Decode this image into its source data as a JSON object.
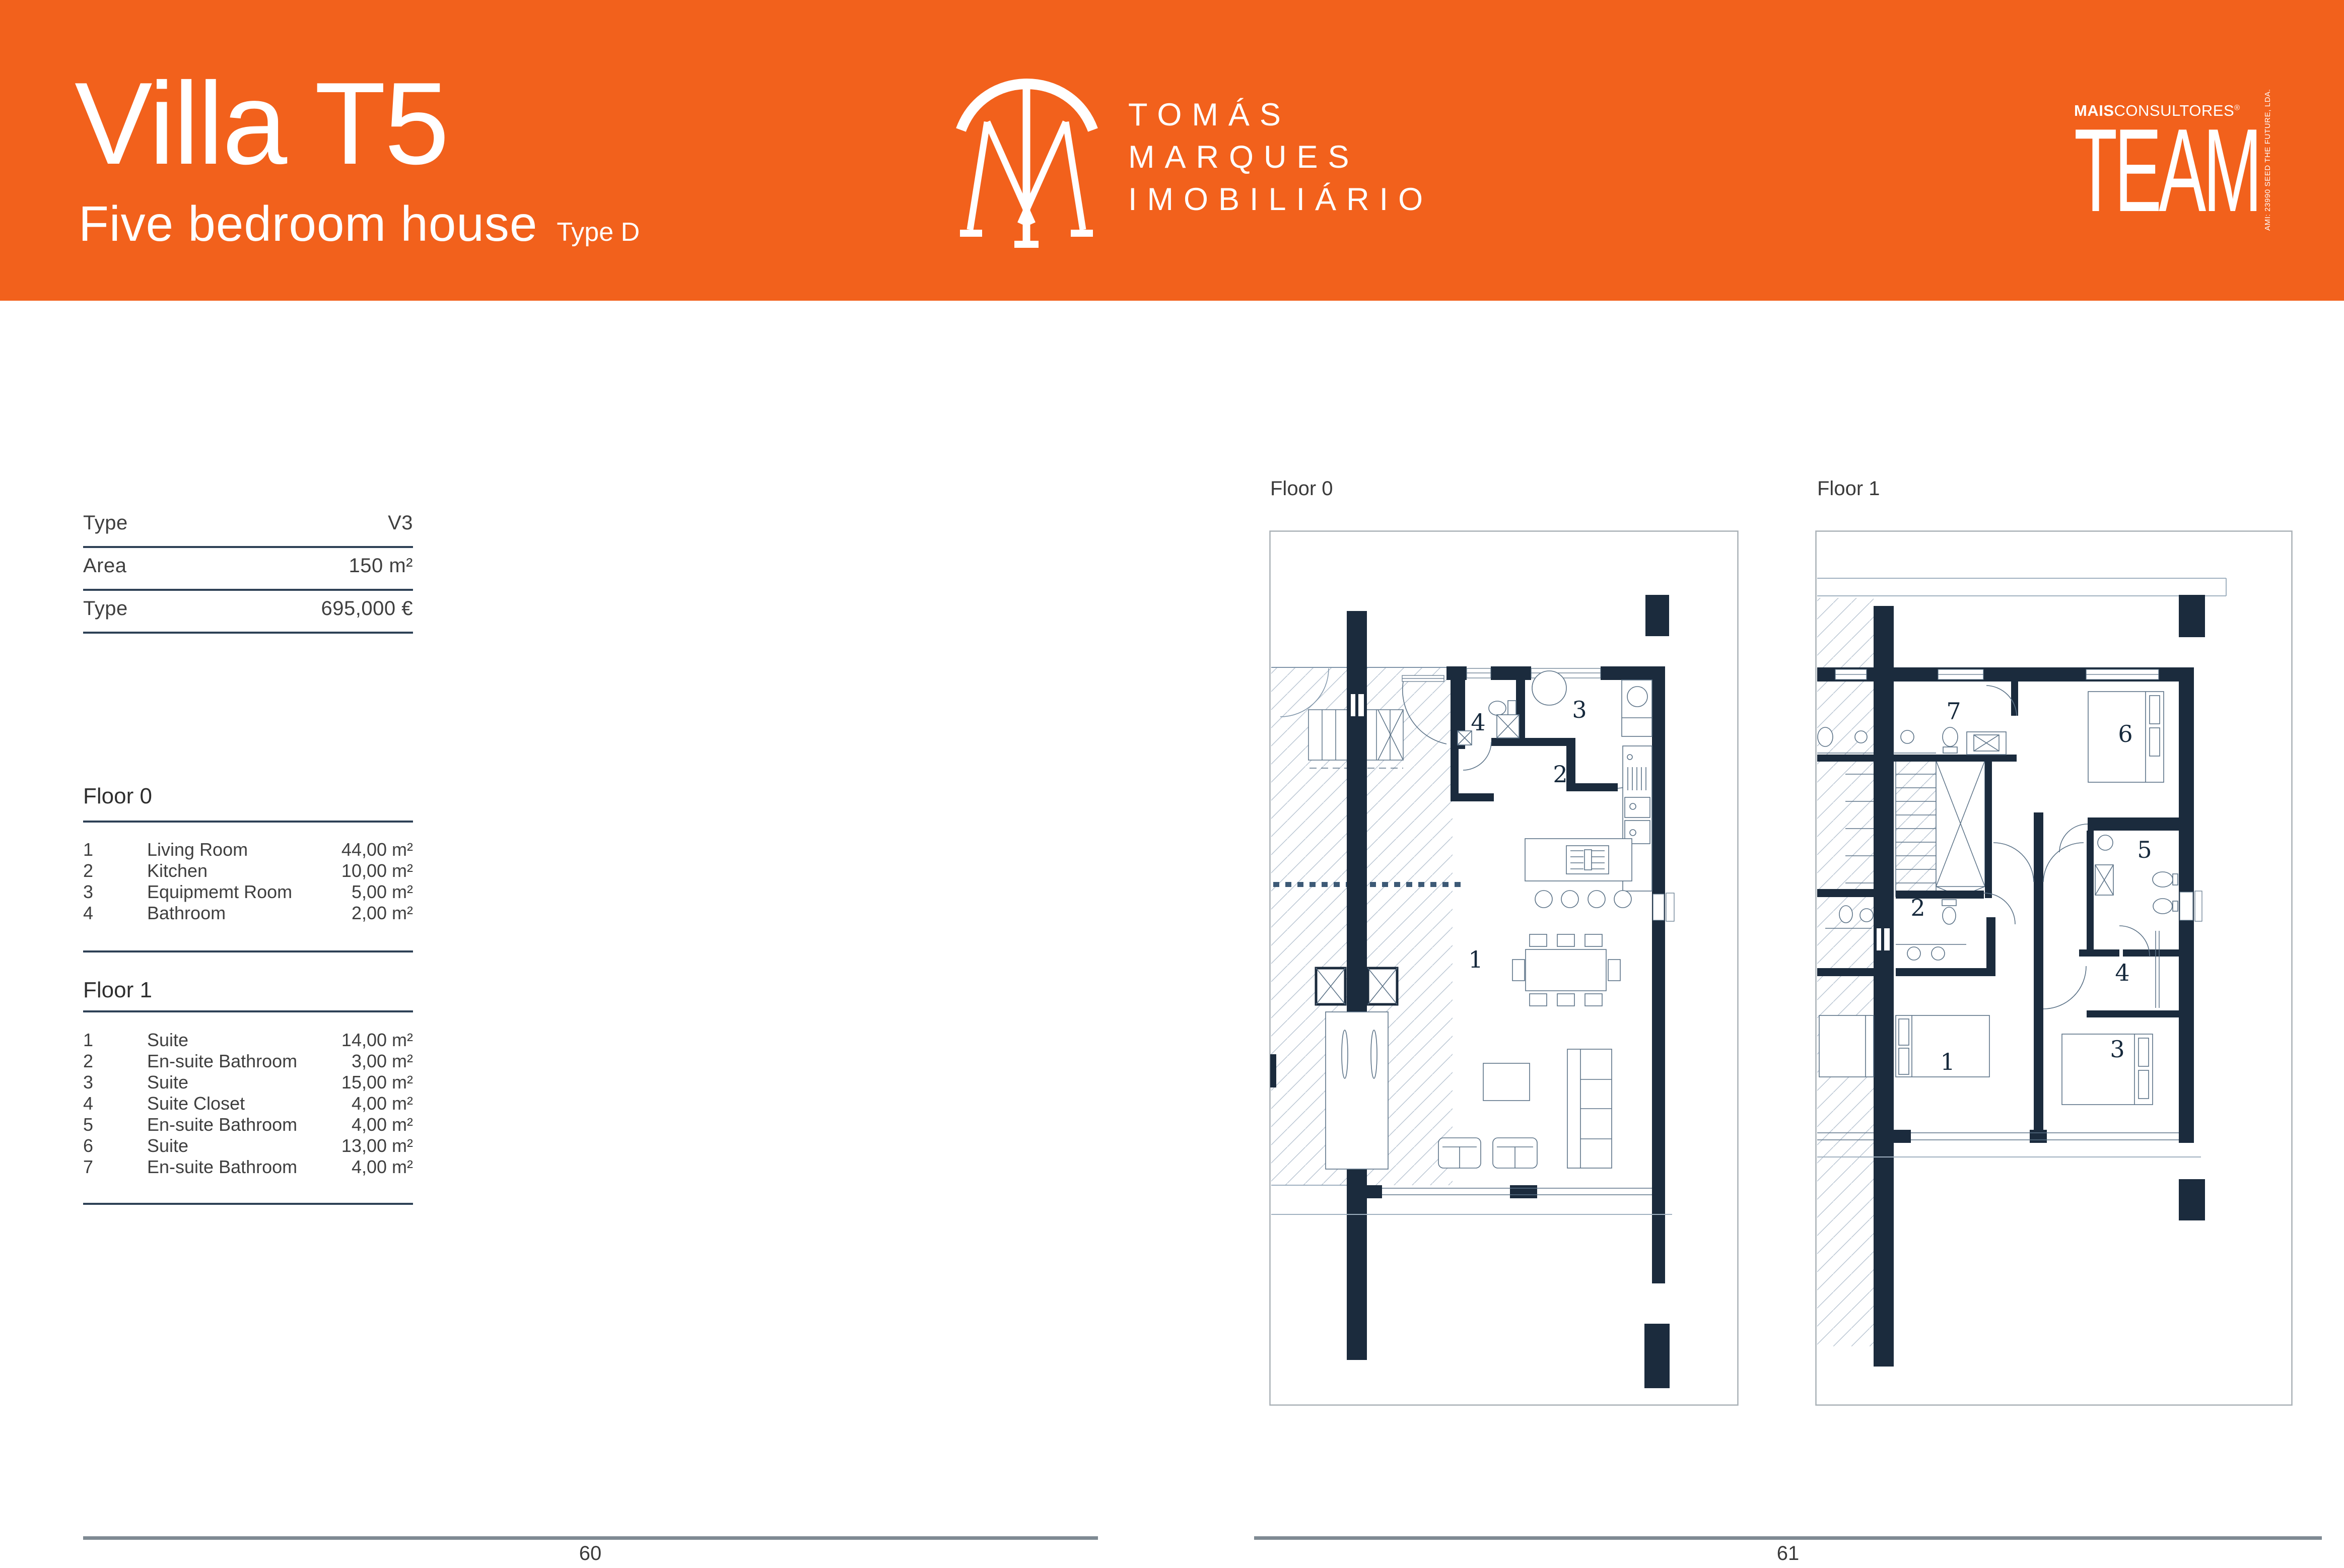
{
  "header": {
    "title": "Villa T5",
    "subtitle": "Five bedroom house",
    "type_tag": "Type D",
    "accent_color": "#F2611C",
    "brand_name_line1": "TOMÁS",
    "brand_name_line2": "MARQUES",
    "brand_name_line3": "IMOBILIÁRIO",
    "partner_brand_bold": "MAIS",
    "partner_brand_rest": "CONSULTORES",
    "partner_reg": "®",
    "partner_word": "TEAM",
    "partner_side_text": "AMI: 23990   SEED THE FUTURE, LDA."
  },
  "specs": {
    "rows": [
      {
        "label": "Type",
        "value": "V3"
      },
      {
        "label": "Area",
        "value": "150 m²"
      },
      {
        "label": "Type",
        "value": "695,000 €"
      }
    ]
  },
  "floor0": {
    "title": "Floor 0",
    "rooms": [
      {
        "num": "1",
        "name": "Living Room",
        "area": "44,00 m²"
      },
      {
        "num": "2",
        "name": "Kitchen",
        "area": "10,00 m²"
      },
      {
        "num": "3",
        "name": "Equipmemt Room",
        "area": "5,00 m²"
      },
      {
        "num": "4",
        "name": "Bathroom",
        "area": "2,00 m²"
      }
    ]
  },
  "floor1": {
    "title": "Floor 1",
    "rooms": [
      {
        "num": "1",
        "name": "Suite",
        "area": "14,00 m²"
      },
      {
        "num": "2",
        "name": "En-suite Bathroom",
        "area": "3,00 m²"
      },
      {
        "num": "3",
        "name": "Suite",
        "area": "15,00 m²"
      },
      {
        "num": "4",
        "name": "Suite Closet",
        "area": "4,00 m²"
      },
      {
        "num": "5",
        "name": "En-suite Bathroom",
        "area": "4,00 m²"
      },
      {
        "num": "6",
        "name": "Suite",
        "area": "13,00 m²"
      },
      {
        "num": "7",
        "name": "En-suite Bathroom",
        "area": "4,00 m²"
      }
    ]
  },
  "plans": {
    "floor0_label": "Floor 0",
    "floor1_label": "Floor 1",
    "wall_color": "#1B2B3D",
    "floor0_numbers": [
      "1",
      "2",
      "3",
      "4"
    ],
    "floor1_numbers": [
      "1",
      "2",
      "3",
      "4",
      "5",
      "6",
      "7"
    ]
  },
  "footer": {
    "left_page": "60",
    "right_page": "61"
  }
}
